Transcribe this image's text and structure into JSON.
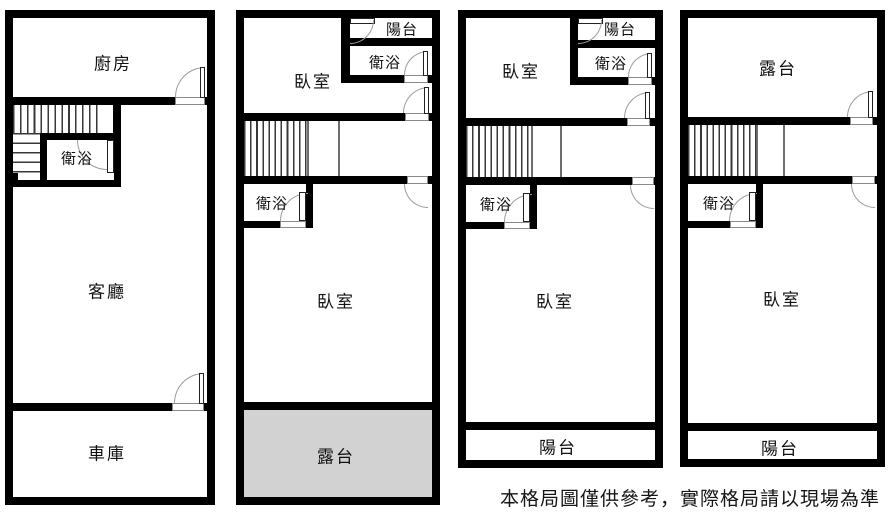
{
  "disclaimer": "本格局圖僅供參考，實際格局請以現場為準",
  "colors": {
    "wall": "#000000",
    "terrace_fill": "#d2d2d2",
    "door_arc": "#9c9c9c",
    "background": "#ffffff"
  },
  "plans": [
    {
      "name": "floor-1",
      "rooms": {
        "kitchen": "廚房",
        "bath": "衛浴",
        "living": "客廳",
        "garage": "車庫"
      }
    },
    {
      "name": "floor-2",
      "rooms": {
        "balcony_top": "陽台",
        "bath_top": "衛浴",
        "bedroom_top": "臥室",
        "bath_mid": "衛浴",
        "bedroom_main": "臥室",
        "terrace": "露台"
      }
    },
    {
      "name": "floor-3",
      "rooms": {
        "balcony_top": "陽台",
        "bath_top": "衛浴",
        "bedroom_top": "臥室",
        "bath_mid": "衛浴",
        "bedroom_main": "臥室",
        "balcony_bottom": "陽台"
      }
    },
    {
      "name": "floor-4",
      "rooms": {
        "terrace_top": "露台",
        "bath_mid": "衛浴",
        "bedroom_main": "臥室",
        "balcony_bottom": "陽台"
      }
    }
  ]
}
